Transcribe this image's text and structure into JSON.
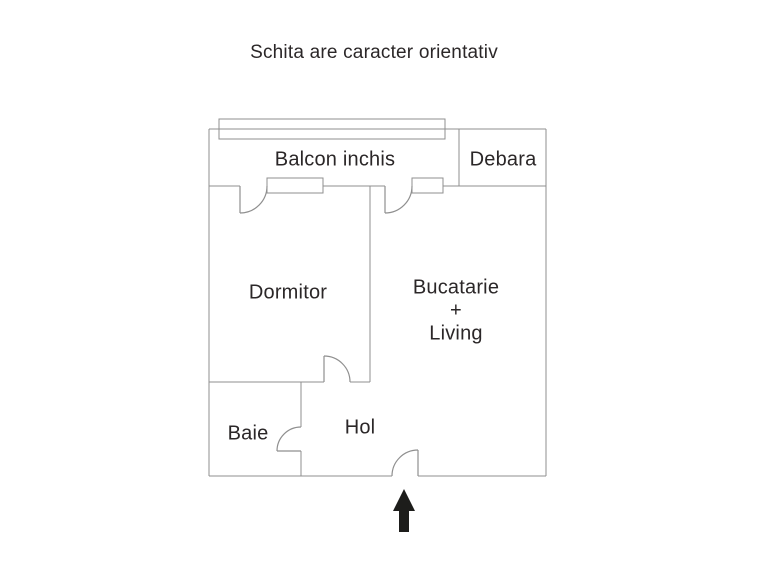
{
  "title": "Schita are caracter orientativ",
  "colors": {
    "wall": "#8f8f8f",
    "text": "#2b2728",
    "arrow": "#1d1d1b",
    "background": "#ffffff"
  },
  "rooms": {
    "balcon": {
      "label": "Balcon inchis"
    },
    "debara": {
      "label": "Debara"
    },
    "dormitor": {
      "label": "Dormitor"
    },
    "bucatarie": {
      "label_line1": "Bucatarie",
      "label_line2": "+",
      "label_line3": "Living"
    },
    "baie": {
      "label": "Baie"
    },
    "hol": {
      "label": "Hol"
    }
  },
  "entrance": {
    "icon": "up-arrow-icon"
  }
}
